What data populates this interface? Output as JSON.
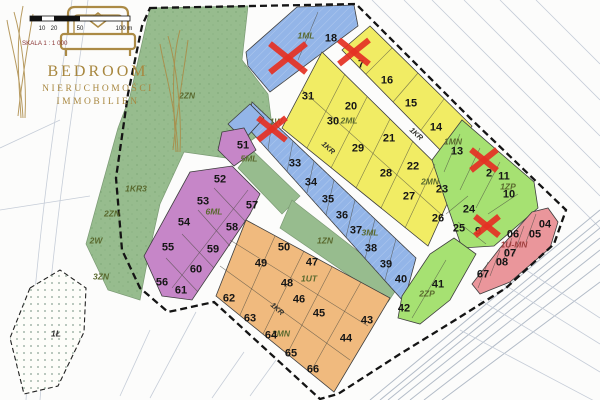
{
  "branding": {
    "name": "BEDROOM",
    "subtitle": "NIERUCHOMOŚCI",
    "subtitle2": "IMMOBILIEN",
    "gold": "#ab8a45"
  },
  "scale_bar": {
    "ticks": [
      "10",
      "20",
      "50",
      "100 m"
    ],
    "caption": "SKALA 1 : 1 000"
  },
  "palette": {
    "yellow_zone": "#f1ec64",
    "lot_green_zone": "#a6e172",
    "nature_green": "#97bc8e",
    "blue_zone": "#93b5e8",
    "purple_zone": "#c686c8",
    "orange_zone": "#f0ba7e",
    "pink_zone": "#ea969b",
    "sold_x": "#e53124",
    "boundary": "#141414"
  },
  "map": {
    "zones": [
      {
        "code": "1ML",
        "labels": [
          {
            "text": "1ML",
            "x": 306,
            "y": 35
          }
        ],
        "lots": [
          {
            "no": "18",
            "x": 331,
            "y": 38
          },
          {
            "no": "",
            "x": 0,
            "y": 0,
            "sold": true,
            "cx": 288,
            "cy": 58,
            "r": 18
          }
        ]
      },
      {
        "code": "2ML / 2MN",
        "labels": [
          {
            "text": "2ML",
            "x": 349,
            "y": 120
          },
          {
            "text": "2MN",
            "x": 430,
            "y": 181
          }
        ],
        "lots": [
          {
            "no": "7",
            "x": 361,
            "y": 64,
            "sold": true,
            "cx": 354,
            "cy": 52,
            "r": 15
          },
          {
            "no": "16",
            "x": 387,
            "y": 80
          },
          {
            "no": "15",
            "x": 411,
            "y": 103
          },
          {
            "no": "14",
            "x": 436,
            "y": 127
          },
          {
            "no": "31",
            "x": 308,
            "y": 96
          },
          {
            "no": "20",
            "x": 351,
            "y": 106
          },
          {
            "no": "30",
            "x": 333,
            "y": 121
          },
          {
            "no": "21",
            "x": 389,
            "y": 138
          },
          {
            "no": "29",
            "x": 358,
            "y": 148
          },
          {
            "no": "22",
            "x": 413,
            "y": 166
          },
          {
            "no": "28",
            "x": 386,
            "y": 173
          },
          {
            "no": "27",
            "x": 409,
            "y": 196
          },
          {
            "no": "23",
            "x": 442,
            "y": 189
          },
          {
            "no": "26",
            "x": 438,
            "y": 218
          }
        ]
      },
      {
        "code": "1MN / 1ZP",
        "labels": [
          {
            "text": "1MN",
            "x": 453,
            "y": 141
          },
          {
            "text": "1ZP",
            "x": 508,
            "y": 186
          }
        ],
        "lots": [
          {
            "no": "13",
            "x": 457,
            "y": 151
          },
          {
            "no": "2",
            "x": 489,
            "y": 173,
            "sold": true,
            "cx": 484,
            "cy": 160,
            "r": 13
          },
          {
            "no": "11",
            "x": 504,
            "y": 176
          },
          {
            "no": "10",
            "x": 509,
            "y": 194
          },
          {
            "no": "24",
            "x": 469,
            "y": 209
          },
          {
            "no": "25",
            "x": 459,
            "y": 228
          },
          {
            "no": "9",
            "x": 478,
            "y": 231,
            "sold": true,
            "cx": 487,
            "cy": 226,
            "r": 12
          }
        ]
      },
      {
        "code": "3ML",
        "labels": [
          {
            "text": "3ML",
            "x": 370,
            "y": 232
          }
        ],
        "lots": [
          {
            "no": "",
            "x": 0,
            "y": 0,
            "sold": true,
            "cx": 272,
            "cy": 129,
            "r": 14
          },
          {
            "no": "33",
            "x": 295,
            "y": 163
          },
          {
            "no": "34",
            "x": 311,
            "y": 182
          },
          {
            "no": "35",
            "x": 328,
            "y": 199
          },
          {
            "no": "36",
            "x": 342,
            "y": 215
          },
          {
            "no": "37",
            "x": 356,
            "y": 230
          },
          {
            "no": "38",
            "x": 371,
            "y": 248
          },
          {
            "no": "39",
            "x": 386,
            "y": 264
          },
          {
            "no": "40",
            "x": 401,
            "y": 279
          }
        ]
      },
      {
        "code": "2ZP",
        "labels": [
          {
            "text": "2ZP",
            "x": 427,
            "y": 293
          }
        ],
        "lots": [
          {
            "no": "41",
            "x": 438,
            "y": 284
          },
          {
            "no": "42",
            "x": 404,
            "y": 308
          }
        ]
      },
      {
        "code": "5ML",
        "labels": [
          {
            "text": "5ML",
            "x": 249,
            "y": 158
          }
        ],
        "lots": [
          {
            "no": "51",
            "x": 243,
            "y": 145
          }
        ]
      },
      {
        "code": "6ML",
        "labels": [
          {
            "text": "6ML",
            "x": 214,
            "y": 211
          }
        ],
        "lots": [
          {
            "no": "52",
            "x": 220,
            "y": 179
          },
          {
            "no": "53",
            "x": 203,
            "y": 201
          },
          {
            "no": "54",
            "x": 184,
            "y": 222
          },
          {
            "no": "55",
            "x": 168,
            "y": 247
          },
          {
            "no": "56",
            "x": 162,
            "y": 282
          },
          {
            "no": "57",
            "x": 252,
            "y": 205
          },
          {
            "no": "58",
            "x": 232,
            "y": 227
          },
          {
            "no": "59",
            "x": 213,
            "y": 249
          },
          {
            "no": "60",
            "x": 196,
            "y": 269
          },
          {
            "no": "61",
            "x": 181,
            "y": 290
          }
        ]
      },
      {
        "code": "1UT / 3MN",
        "labels": [
          {
            "text": "1UT",
            "x": 309,
            "y": 278
          },
          {
            "text": "3MN",
            "x": 281,
            "y": 333
          }
        ],
        "lots": [
          {
            "no": "50",
            "x": 284,
            "y": 247
          },
          {
            "no": "49",
            "x": 261,
            "y": 263
          },
          {
            "no": "48",
            "x": 287,
            "y": 283
          },
          {
            "no": "47",
            "x": 312,
            "y": 262
          },
          {
            "no": "46",
            "x": 299,
            "y": 299
          },
          {
            "no": "45",
            "x": 319,
            "y": 313
          },
          {
            "no": "44",
            "x": 346,
            "y": 338
          },
          {
            "no": "43",
            "x": 367,
            "y": 320
          },
          {
            "no": "62",
            "x": 229,
            "y": 298
          },
          {
            "no": "63",
            "x": 250,
            "y": 318
          },
          {
            "no": "64",
            "x": 271,
            "y": 335
          },
          {
            "no": "65",
            "x": 291,
            "y": 353
          },
          {
            "no": "66",
            "x": 313,
            "y": 369
          }
        ]
      },
      {
        "code": "1U-MN",
        "labels": [
          {
            "text": "1U-MN",
            "x": 514,
            "y": 244,
            "color": "#a04040"
          }
        ],
        "lots": [
          {
            "no": "04",
            "x": 545,
            "y": 224
          },
          {
            "no": "05",
            "x": 535,
            "y": 234
          },
          {
            "no": "06",
            "x": 513,
            "y": 234
          },
          {
            "no": "07",
            "x": 510,
            "y": 253
          },
          {
            "no": "08",
            "x": 502,
            "y": 262
          },
          {
            "no": "67",
            "x": 483,
            "y": 274
          }
        ]
      }
    ],
    "road_labels": [
      {
        "text": "1KR",
        "x": 417,
        "y": 133,
        "rot": 42
      },
      {
        "text": "1KR",
        "x": 329,
        "y": 147,
        "rot": 42
      },
      {
        "text": "1KR",
        "x": 278,
        "y": 308,
        "rot": 42
      }
    ],
    "area_labels": [
      {
        "text": "2ZN",
        "x": 187,
        "y": 95
      },
      {
        "text": "2ZN",
        "x": 112,
        "y": 213
      },
      {
        "text": "2W",
        "x": 96,
        "y": 240
      },
      {
        "text": "3ZN",
        "x": 101,
        "y": 276
      },
      {
        "text": "1KR3",
        "x": 136,
        "y": 188
      },
      {
        "text": "1Ł",
        "x": 56,
        "y": 333,
        "color": "#333333"
      },
      {
        "text": "1W",
        "x": 276,
        "y": 121
      },
      {
        "text": "1ZN",
        "x": 325,
        "y": 240
      }
    ]
  }
}
